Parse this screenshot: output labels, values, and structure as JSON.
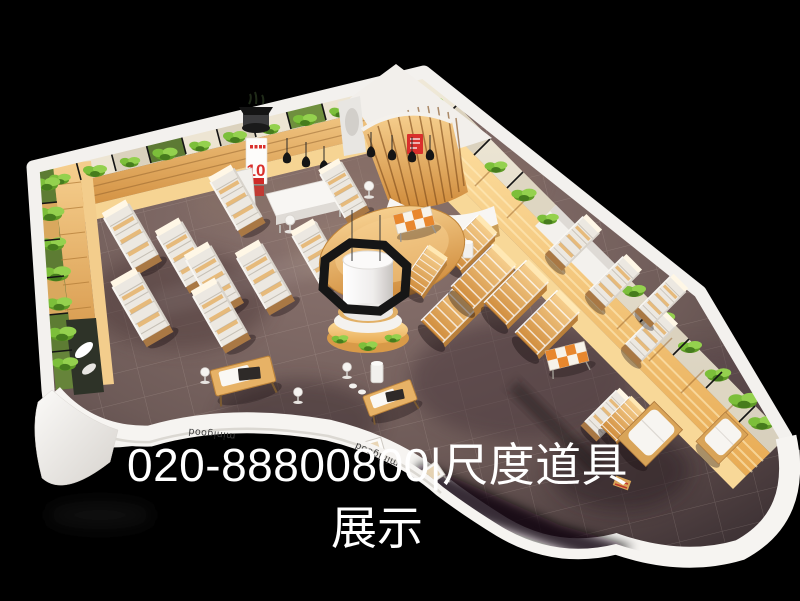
{
  "overlay": {
    "line1": "020-88800800|尺度道具",
    "line2": "展示"
  },
  "storefront": {
    "brand_left": "minigood",
    "brand_right": "minigood"
  },
  "promo_banner": {
    "number": "10"
  },
  "palette": {
    "background": "#000000",
    "floor": "#6e5b58",
    "wood": "#e0a050",
    "wood_bright": "#f8d494",
    "plant_green": "#76b433",
    "wall_white": "#f2efeb",
    "accent_red": "#d9302c",
    "octagon": "#161616"
  }
}
